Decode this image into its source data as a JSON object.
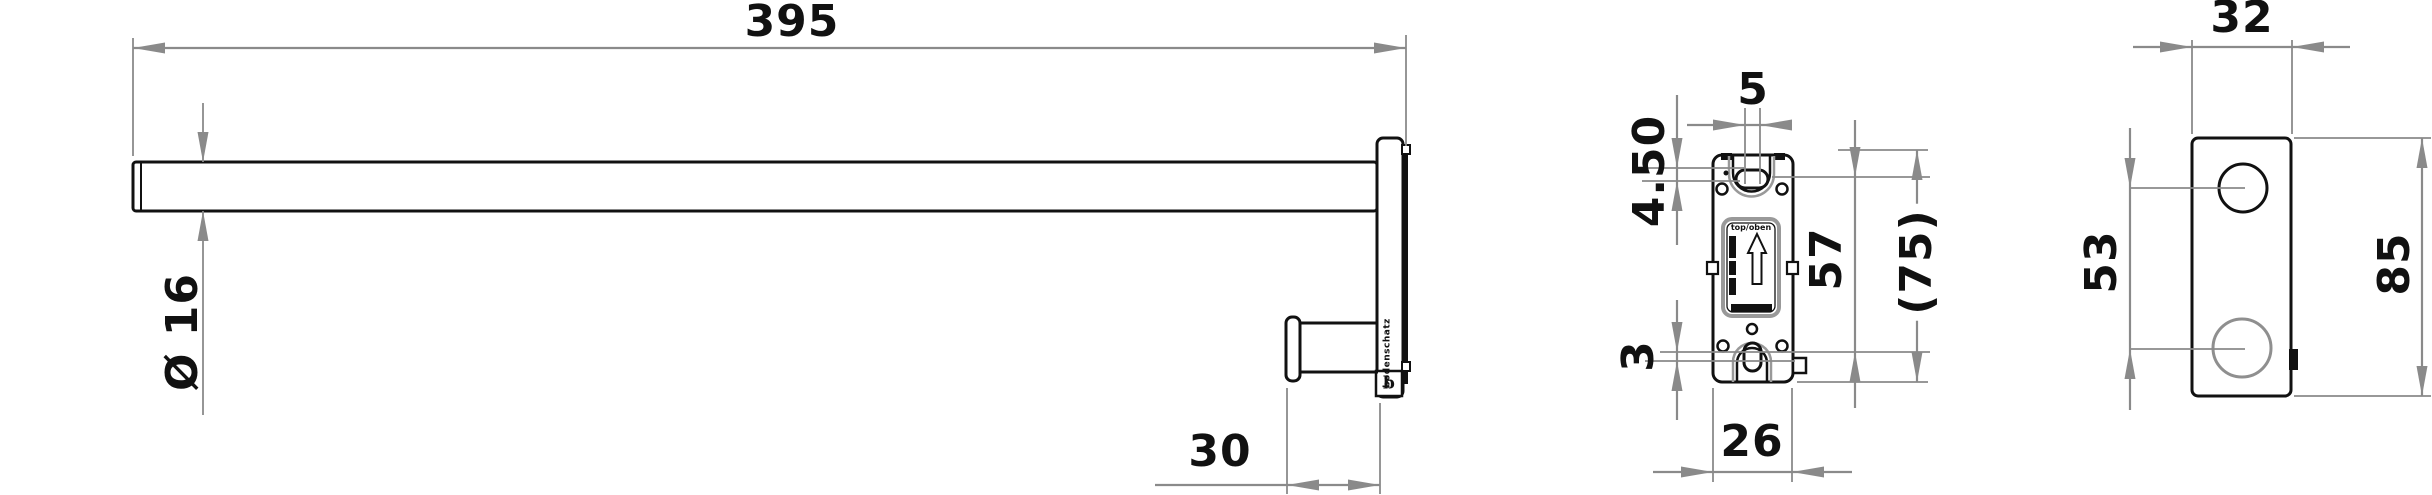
{
  "colors": {
    "outline": "#111111",
    "dimension": "#8a8a8a",
    "hidden_edge": "#999999",
    "background": "#ffffff"
  },
  "side_view": {
    "length": "395",
    "diameter": "Ø 16",
    "hook_offset": "30",
    "brand_vertical": "bodenschatz",
    "logo_glyph": "b"
  },
  "front_view": {
    "slot_width": "5",
    "edge_to_slot": "4.50",
    "hole_spacing": "57",
    "reference_height": "(75)",
    "bottom_offset": "3",
    "width": "26",
    "label_top": "top/oben"
  },
  "end_view": {
    "depth": "32",
    "hole_spacing": "53",
    "height": "85"
  }
}
